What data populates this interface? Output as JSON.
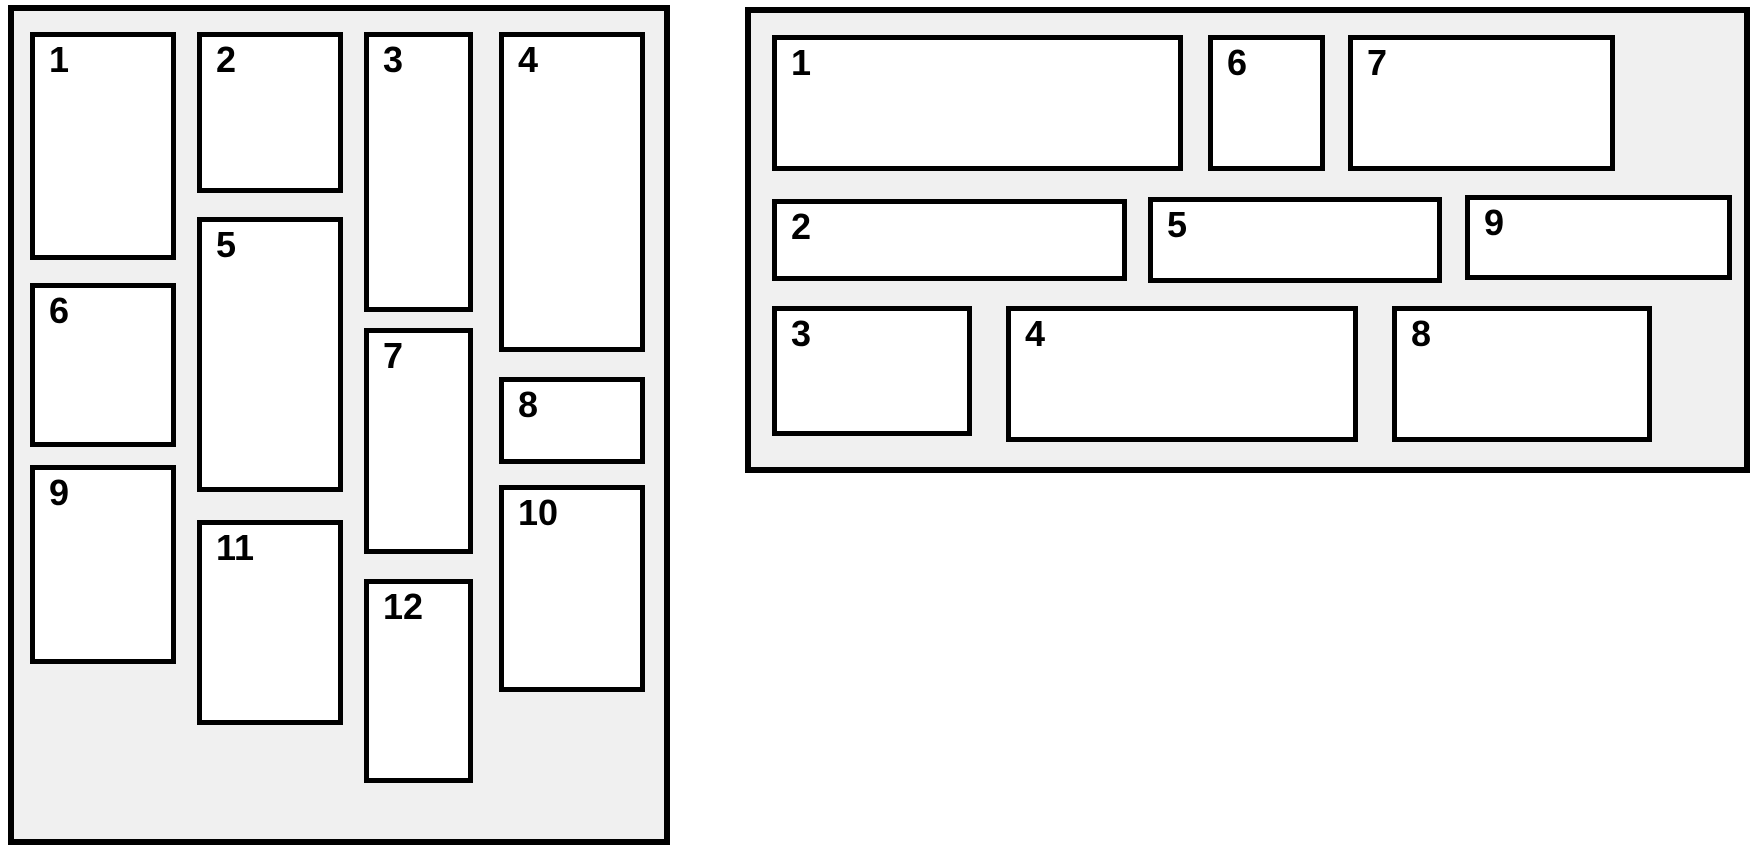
{
  "page": {
    "width": 1755,
    "height": 852,
    "background": "#ffffff"
  },
  "styles": {
    "panel_fill": "#f0f0f0",
    "panel_border_color": "#000000",
    "panel_border_width": 6,
    "box_fill": "#ffffff",
    "box_border_color": "#000000",
    "box_border_width": 5,
    "number_color": "#000000"
  },
  "panels": [
    {
      "id": "masonry-panel",
      "x": 8,
      "y": 5,
      "w": 662,
      "h": 840,
      "items": [
        {
          "label": "1",
          "x": 30,
          "y": 32,
          "w": 146,
          "h": 228
        },
        {
          "label": "2",
          "x": 197,
          "y": 32,
          "w": 146,
          "h": 161
        },
        {
          "label": "3",
          "x": 364,
          "y": 32,
          "w": 109,
          "h": 280
        },
        {
          "label": "4",
          "x": 499,
          "y": 32,
          "w": 146,
          "h": 320
        },
        {
          "label": "5",
          "x": 197,
          "y": 217,
          "w": 146,
          "h": 275
        },
        {
          "label": "6",
          "x": 30,
          "y": 283,
          "w": 146,
          "h": 164
        },
        {
          "label": "7",
          "x": 364,
          "y": 328,
          "w": 109,
          "h": 226
        },
        {
          "label": "8",
          "x": 499,
          "y": 377,
          "w": 146,
          "h": 87
        },
        {
          "label": "9",
          "x": 30,
          "y": 465,
          "w": 146,
          "h": 199
        },
        {
          "label": "10",
          "x": 499,
          "y": 485,
          "w": 146,
          "h": 207
        },
        {
          "label": "11",
          "x": 197,
          "y": 520,
          "w": 146,
          "h": 205
        },
        {
          "label": "12",
          "x": 364,
          "y": 579,
          "w": 109,
          "h": 204
        }
      ]
    },
    {
      "id": "row-grid-panel",
      "x": 745,
      "y": 7,
      "w": 1005,
      "h": 466,
      "items": [
        {
          "label": "1",
          "x": 772,
          "y": 35,
          "w": 411,
          "h": 136
        },
        {
          "label": "2",
          "x": 772,
          "y": 199,
          "w": 355,
          "h": 82
        },
        {
          "label": "3",
          "x": 772,
          "y": 306,
          "w": 200,
          "h": 130
        },
        {
          "label": "4",
          "x": 1006,
          "y": 306,
          "w": 352,
          "h": 136
        },
        {
          "label": "5",
          "x": 1148,
          "y": 197,
          "w": 294,
          "h": 86
        },
        {
          "label": "6",
          "x": 1208,
          "y": 35,
          "w": 117,
          "h": 136
        },
        {
          "label": "7",
          "x": 1348,
          "y": 35,
          "w": 267,
          "h": 136
        },
        {
          "label": "8",
          "x": 1392,
          "y": 306,
          "w": 260,
          "h": 136
        },
        {
          "label": "9",
          "x": 1465,
          "y": 195,
          "w": 267,
          "h": 85
        }
      ]
    }
  ]
}
